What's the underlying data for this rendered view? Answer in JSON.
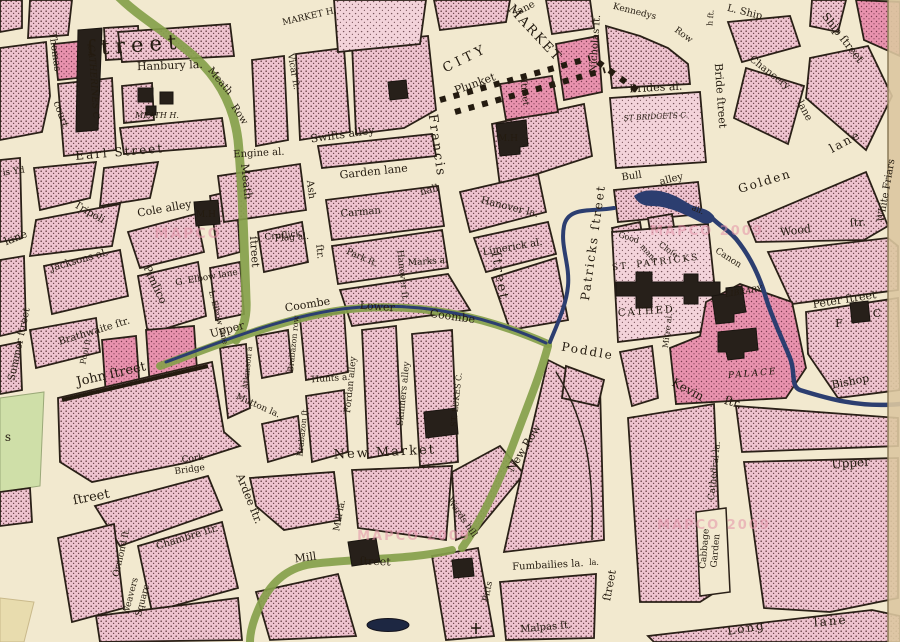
{
  "map": {
    "palette": {
      "paper": "#f2e9cf",
      "block_pink": "#eec3cf",
      "bright_pink": "#e786a6",
      "pale_pink": "#f3d3da",
      "road_green": "#85a04b",
      "river_blue": "#2c3e70",
      "ink": "#241b10",
      "watermark_pink": "#e492a8"
    },
    "labels": [
      "ſtreet",
      "Thomas",
      "court",
      "CATHERINES C",
      "Hanbury la.",
      "MEATH H.",
      "Earl Street",
      "is Yd",
      "lane",
      "Jacksons al.",
      "Tripoli",
      "Cole alley",
      "M.H",
      "Pimlico",
      "G. Elbow lane",
      "L. Elbow lane",
      "Brathwaite ſtr.",
      "Pool ſt",
      "John ſtreet",
      "Summer ſtreet",
      "s",
      "ſtreet",
      "Cork",
      "Bridge",
      "Ardee ſtr.",
      "Chambre ſtr.",
      "Ormond ſt.",
      "Weavers",
      "Square",
      "Mutton la.",
      "Atkinson a",
      "Brabazon row",
      "Brabazon ſt.",
      "Hunts a.",
      "Fordan alley",
      "Skinners alley",
      "ST. LUKES C.",
      "New Market",
      "Mill la.",
      "Mill",
      "ſtreet",
      "Wards hill",
      "New Row",
      "Meath",
      "Row",
      "Meath",
      "ſtreet",
      "Engine al.",
      "Swifts alley",
      "Garden lane",
      "Cruſlick",
      "Ash",
      "ſtr.",
      "Carman",
      "hall",
      "Flag al.",
      "Park ſt.",
      "Marks al",
      "Hanover la.",
      "Limerick al.",
      "Hanover ſt.",
      "Vicar ſt.",
      "MARKET H.",
      "CITY",
      "MARKET",
      "lane",
      "Plunket",
      "ſtreet",
      "M.H",
      "Francis",
      "ſtreet",
      "Nicholas ſt.",
      "Kennedys",
      "Row",
      "h ſt.",
      "Bride ſtreet",
      "Brides al.",
      "ST BRIDGETS C.",
      "Bull",
      "alley",
      "L. Ship",
      "Ship ſtreet",
      "Chancery",
      "lane",
      "Golden",
      "lane",
      "White Friars",
      "Wood",
      "ſtr.",
      "Good",
      "mans",
      "Cloſe",
      "all.",
      "Canon",
      "ST. PATRICKS",
      "CATHED.",
      "LIBRARY",
      "PALACE",
      "Patricks ſtreet",
      "Poddle",
      "Upper",
      "Coombe",
      "Lower",
      "Coombe",
      "Mitre al.",
      "Kevin",
      "ſtr.",
      "Peter ſtreet",
      "F",
      "C",
      "Bishop",
      "Upper",
      "Cathedral la.",
      "Cabbage",
      "Garden",
      "ſtreet",
      "la.",
      "Pitts",
      "Fumbailies la.",
      "Malpas ſt.",
      "Long",
      "lane"
    ],
    "watermarks": [
      "MAPCO",
      "MAPCO 2009",
      "MAPCO 2009",
      "MAPCO 2009"
    ]
  }
}
